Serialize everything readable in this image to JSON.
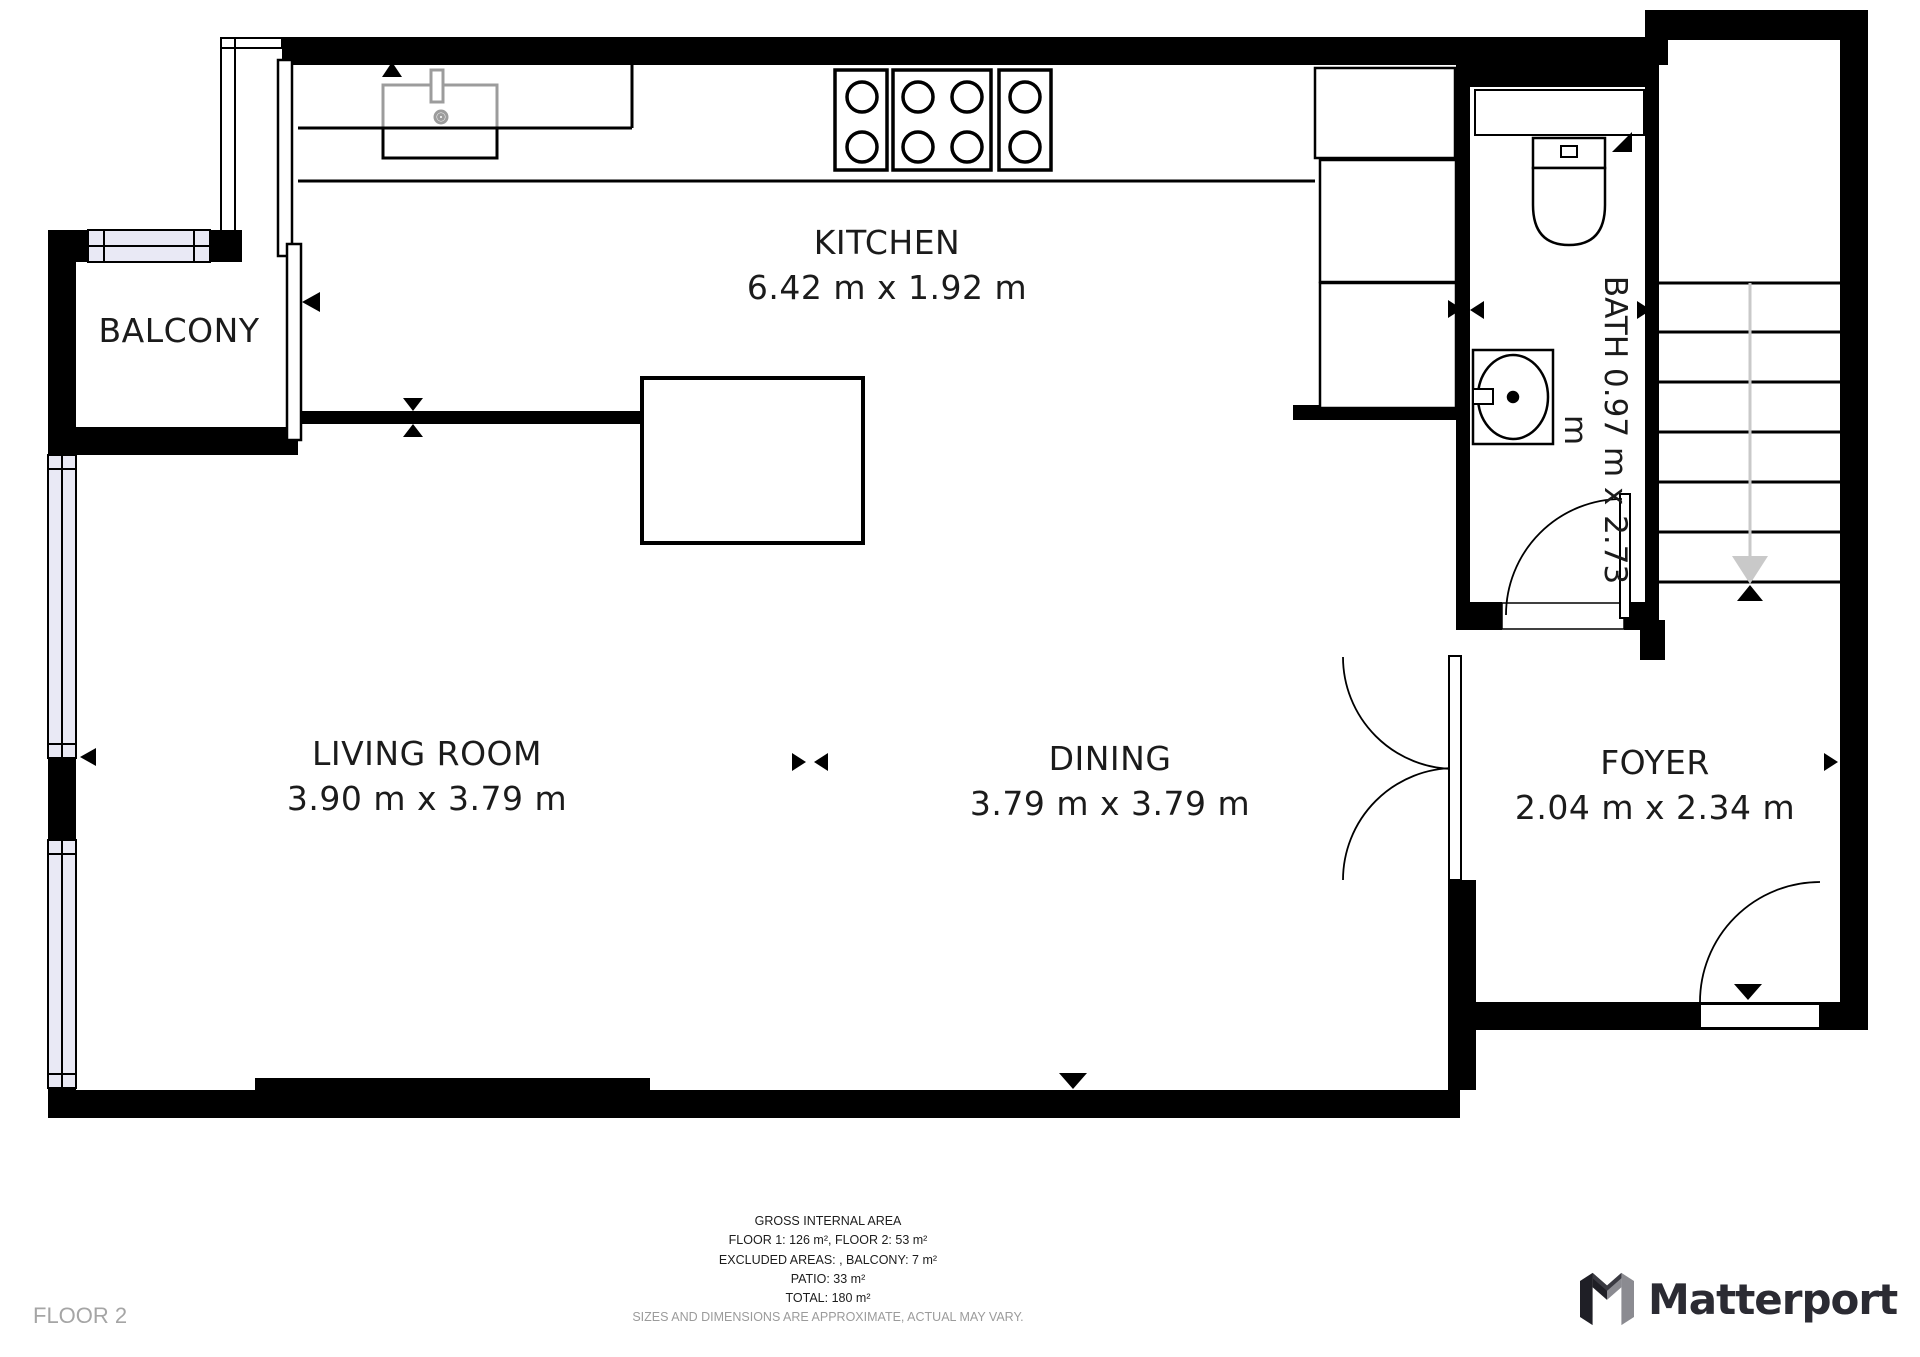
{
  "plan": {
    "rooms": [
      {
        "id": "kitchen",
        "name": "KITCHEN",
        "dims": "6.42 m x 1.92 m"
      },
      {
        "id": "living-room",
        "name": "LIVING ROOM",
        "dims": "3.90 m x 3.79 m"
      },
      {
        "id": "dining",
        "name": "DINING",
        "dims": "3.79 m x 3.79 m"
      },
      {
        "id": "foyer",
        "name": "FOYER",
        "dims": "2.04 m x 2.34 m"
      },
      {
        "id": "bath",
        "name": "BATH",
        "dims": "0.97 m x 2.73 m"
      },
      {
        "id": "balcony",
        "name": "BALCONY",
        "dims": ""
      }
    ]
  },
  "footer": {
    "title": "GROSS INTERNAL AREA",
    "lines": [
      "FLOOR 1: 126 m², FLOOR 2: 53 m²",
      "EXCLUDED AREAS: , BALCONY: 7 m²",
      "PATIO: 33 m²",
      "TOTAL: 180 m²"
    ],
    "disclaimer": "SIZES AND DIMENSIONS ARE APPROXIMATE, ACTUAL MAY VARY.",
    "floor_label": "FLOOR 2"
  },
  "branding": {
    "logo_text": "Matterport"
  },
  "colors": {
    "wall": "#000000",
    "window_fill": "#e9e9f5",
    "fixture_gray": "#9c9c9c",
    "stair_arrow": "#c9c9c9",
    "muted_text": "#9b9b9b",
    "logo_dark": "#1f1f26",
    "logo_gray": "#8b8b91",
    "logo_text": "#2b2b33"
  }
}
